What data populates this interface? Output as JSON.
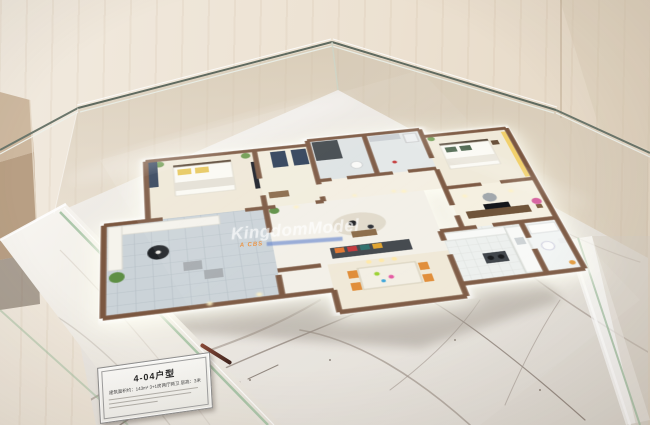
{
  "alt": "Photograph of an apartment floor-plan scale model displayed inside a glass showcase on a marble base",
  "watermark": {
    "line1": "KingdomModel",
    "line2": "A CBS"
  },
  "plaque": {
    "title": "4-04户型",
    "subtitle": "建筑面积约：143m²  3+1房两厅两卫  层高：3米"
  },
  "colors": {
    "model_wall_wood": "#7b5740",
    "marble_base": "#ebe7e1",
    "glass_edge": "#9fbf9f",
    "balcony_tile": "#cbd3d8",
    "accent_orange": "#e08b35",
    "accent_yellow": "#e7c85e",
    "furniture_navy": "#32425a"
  }
}
